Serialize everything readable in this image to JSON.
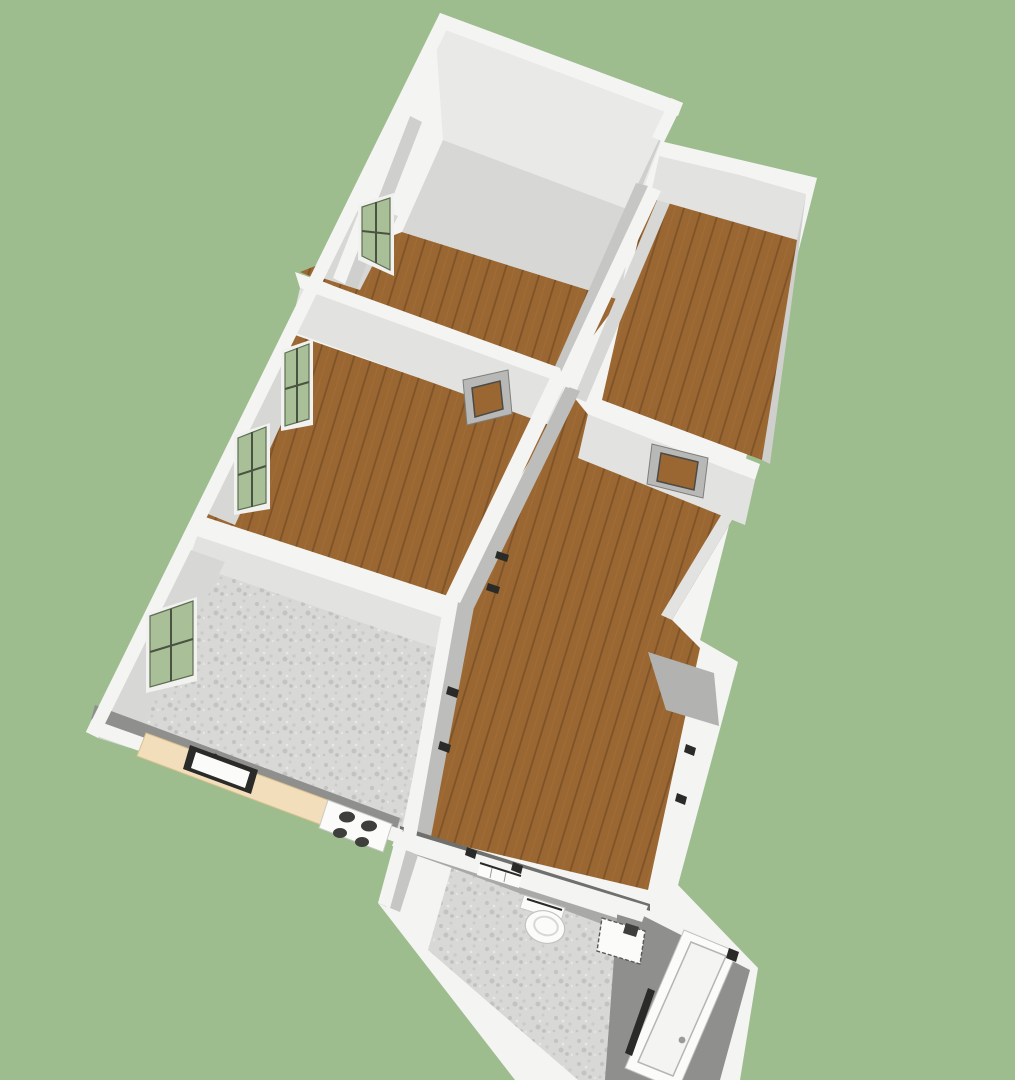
{
  "scene": {
    "title": "3D apartment floor plan render",
    "description": "Axonometric 3D rendering of an apartment floor plan on a green background: white-topped walls, gray wall faces, wooden plank floors in the main rooms, speckled tile floors in kitchen and bathroom, a kitchen counter with sink and stove, and a bathroom with toilet, washbasin and bathtub"
  },
  "palette": {
    "background": "#9ebd8e",
    "wall_top": "#f4f4f2",
    "face_bright": "#e9e9e7",
    "face_light": "#e2e2e0",
    "face_soft": "#d7d7d5",
    "face_mid": "#cfcfcd",
    "face_med2": "#c6c6c4",
    "face_shaded": "#bdbdbb",
    "face_dark": "#b2b2b0",
    "face_deep": "#a9a9a7",
    "face_darkest": "#8f8f8d",
    "contact_line": "#6f6f6d",
    "wood_base": "#9a6732",
    "plank_line": "#5c3a1b",
    "plank_light": "#b5854e",
    "tile_base": "#d8d8d6",
    "speckle_dark": "#c3c3c1",
    "speckle_mid": "#cbcbc9",
    "speckle_light": "#e8e8e6",
    "counter_top": "#f2debb",
    "counter_edge": "#d9c08f",
    "glass_green": "#a9bf97",
    "glass_green_dark": "#94ad80",
    "window_frame_white": "#f1f1ef",
    "window_mullion_dark": "#4a5242",
    "window_outline": "#5e6e52",
    "passthrough_frame": "#b8b8b6",
    "passthrough_outline": "#7e7e7c",
    "fixture_white": "#fbfbf9",
    "fixture_outline": "#b5b5b3",
    "fixture_dark": "#2a2a28",
    "burner_dark": "#3e3e3c",
    "floor_blank": "#e8e8e6"
  },
  "rooms": [
    {
      "id": "top-room",
      "label": "top room",
      "floor": "wood"
    },
    {
      "id": "bedroom",
      "label": "bedroom with two windows",
      "floor": "wood"
    },
    {
      "id": "side-room",
      "label": "upper right room",
      "floor": "wood"
    },
    {
      "id": "hallway",
      "label": "L-shaped hallway / living area",
      "floor": "wood"
    },
    {
      "id": "kitchen",
      "label": "kitchen",
      "floor": "tile"
    },
    {
      "id": "bathroom",
      "label": "bathroom",
      "floor": "tile"
    }
  ],
  "fixtures": [
    {
      "id": "kitchen-counter",
      "label": "kitchen counter"
    },
    {
      "id": "kitchen-sink",
      "label": "kitchen sink"
    },
    {
      "id": "kitchen-stove",
      "label": "stove with four burners"
    },
    {
      "id": "bath-door-leaf",
      "label": "open door leaf"
    },
    {
      "id": "toilet",
      "label": "toilet"
    },
    {
      "id": "washbasin",
      "label": "washbasin"
    },
    {
      "id": "bathtub",
      "label": "bathtub"
    }
  ],
  "windows": {
    "exterior_green_windows": 4,
    "interior_passthrough_windows": 2,
    "door_openings": 4
  }
}
